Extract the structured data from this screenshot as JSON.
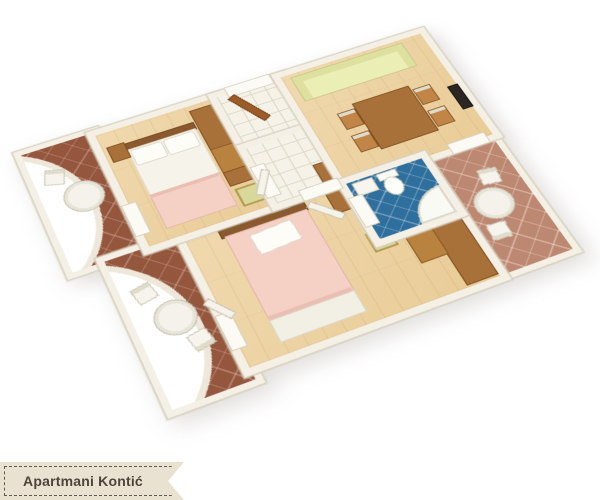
{
  "banner": {
    "label": "Apartmani Kontić",
    "background": "#e9e2d1",
    "border_color": "#5e584f",
    "text_color": "#4e443a"
  },
  "floor_plan": {
    "view": "3d-isometric-apartment-floor-plan",
    "background": "#ffffff",
    "palette": {
      "wall": "#f4f0e5",
      "wall_edge": "#d8d1c0",
      "wood_floor": "#ecd2a2",
      "white_tile": "#f5f2e8",
      "bathroom_tile": "#2f6f9d",
      "balcony_tile_dark": "#95563e",
      "balcony_tile_light": "#bd8871",
      "furniture_wood": "#a9713a",
      "sofa": "#ebeeb5",
      "blanket_pink": "#f5d0c5",
      "linen_white": "#f6f3ea"
    },
    "rooms": [
      {
        "id": "bedroom-1",
        "floor": "wood",
        "furniture": [
          "double-bed",
          "wardrobe-unit",
          "dresser",
          "nightstand",
          "stool"
        ]
      },
      {
        "id": "entry-hall",
        "floor": "white-tile",
        "furniture": [
          "entrance-door-open"
        ]
      },
      {
        "id": "hallway",
        "floor": "white-tile",
        "furniture": [
          "cabinet"
        ]
      },
      {
        "id": "living-dining-room",
        "floor": "wood",
        "furniture": [
          "sofa",
          "dining-table",
          "chair",
          "chair",
          "chair",
          "chair",
          "tv",
          "balcony-door"
        ]
      },
      {
        "id": "bathroom",
        "floor": "blue-tile",
        "furniture": [
          "sink",
          "toilet",
          "shower"
        ]
      },
      {
        "id": "bedroom-2",
        "floor": "wood",
        "furniture": [
          "double-bed",
          "wardrobe-desk-unit",
          "stool",
          "cabinet",
          "balcony-door"
        ]
      },
      {
        "id": "balcony-west-upper",
        "floor": "terracotta-dark",
        "furniture": [
          "round-table",
          "chair"
        ]
      },
      {
        "id": "balcony-west-lower",
        "floor": "terracotta-dark",
        "furniture": [
          "round-table",
          "chair",
          "chair"
        ]
      },
      {
        "id": "balcony-east",
        "floor": "terracotta-light",
        "furniture": [
          "round-table",
          "chair",
          "chair"
        ]
      }
    ]
  }
}
